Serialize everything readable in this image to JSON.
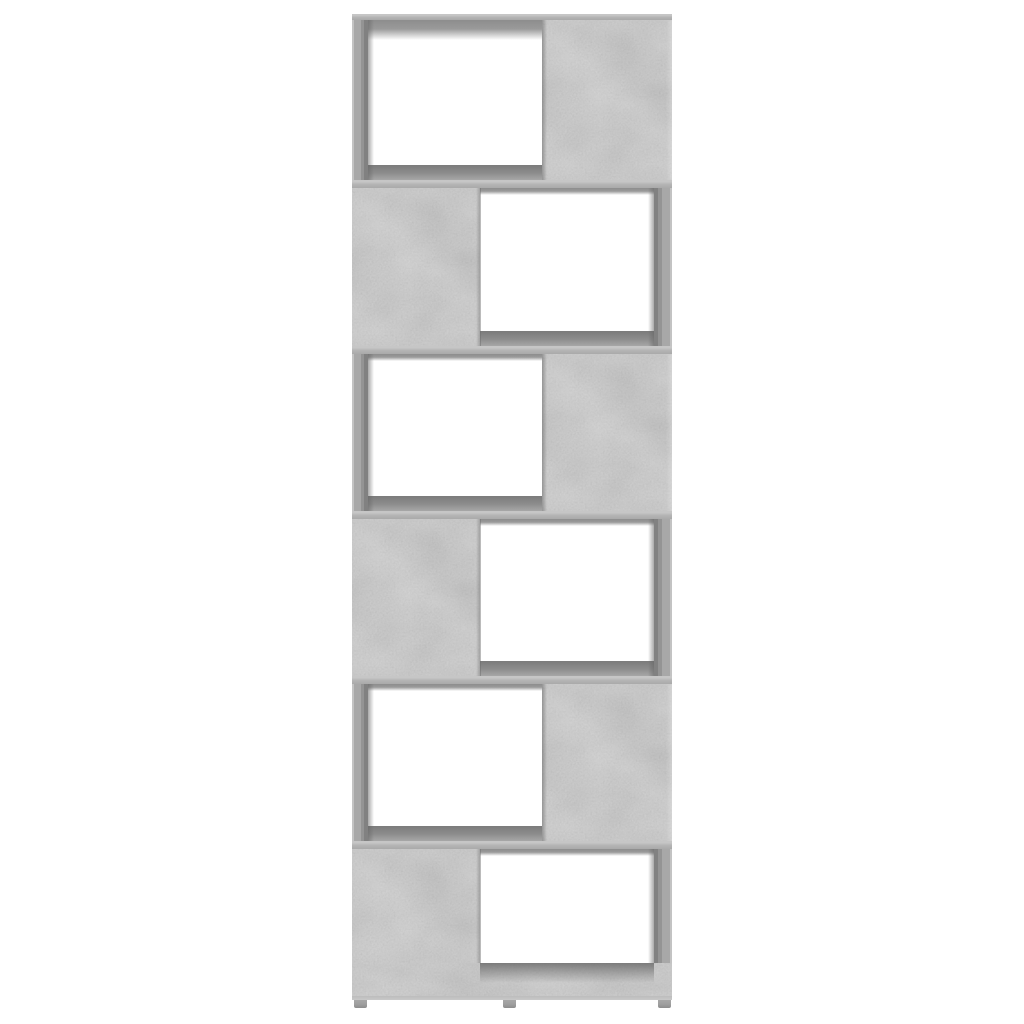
{
  "image": {
    "type": "product-photo",
    "subject": "bookcase-room-divider",
    "alt": "Front view of a six-tier zigzag book cabinet / room divider in concrete grey standing on three small feet against a plain white background",
    "background_color": "#ffffff"
  },
  "bookcase": {
    "finish": "concrete-grey",
    "tier_count": 6,
    "feet_count": 3,
    "tiers": [
      {
        "name": "tier-1",
        "open_side": "left",
        "panel_side": "right"
      },
      {
        "name": "tier-2",
        "open_side": "right",
        "panel_side": "left"
      },
      {
        "name": "tier-3",
        "open_side": "left",
        "panel_side": "right"
      },
      {
        "name": "tier-4",
        "open_side": "right",
        "panel_side": "left"
      },
      {
        "name": "tier-5",
        "open_side": "left",
        "panel_side": "right"
      },
      {
        "name": "tier-6",
        "open_side": "right",
        "panel_side": "left"
      }
    ],
    "colors": {
      "background": "#ffffff",
      "opening": "#ffffff",
      "panel": "#b0b0b0",
      "band": "#b4b4b4",
      "band-light": "#c6c6c6",
      "wall-mid": "#a8a8a8",
      "wall-inner": "#818181",
      "shadow-dark": "#7b7b7b",
      "shadow-mid": "#8d8d8d",
      "foot": "#9e9e9e"
    }
  }
}
